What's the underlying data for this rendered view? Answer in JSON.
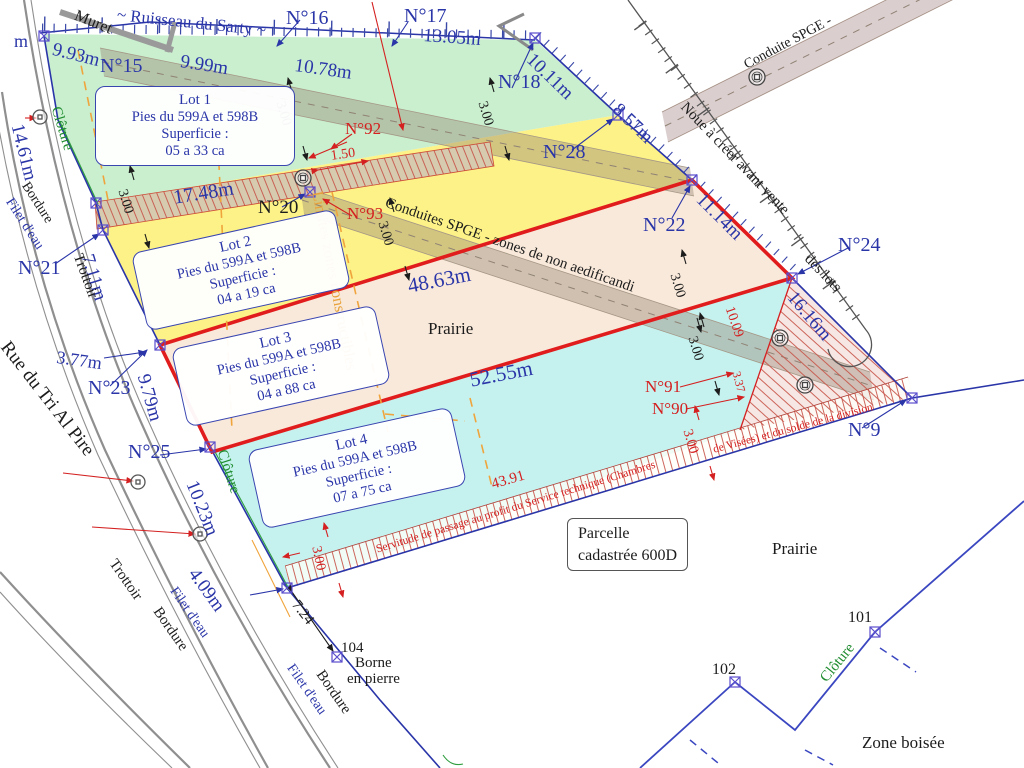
{
  "labels": {
    "ruisseau": "~ Ruisseau du Sarty ~",
    "muret": "Muret",
    "m_cut": "m",
    "n15": "N°15",
    "n16": "N°16",
    "n17": "N°17",
    "n18": "N°18",
    "n20": "N°20",
    "n21": "N°21",
    "n22": "N°22",
    "n23": "N°23",
    "n24": "N°24",
    "n25": "N°25",
    "n28": "N°28",
    "n9": "N°9",
    "n90": "N°90",
    "n91": "N°91",
    "n92": "N°92",
    "n93": "N°93",
    "d993": "9.93m",
    "d999": "9.99m",
    "d1078": "10.78m",
    "d1305": "13.05m",
    "d1011": "10.11m",
    "d857": "8.57m",
    "d1114": "11.14m",
    "d1616": "16.16m",
    "d1461": "14.61m",
    "d711": "7.11m",
    "d377": "3.77m",
    "d979": "9.79m",
    "d1023": "10.23m",
    "d409": "4.09m",
    "d1748": "17.48m",
    "d4863": "48.63m",
    "d5255": "52.55m",
    "d4391": "43.91",
    "d1009": "10.09",
    "d337": "3.37",
    "d150": "1.50",
    "d300": "3.00",
    "d724": "7.24",
    "noue1": "Noue à créer avant vente",
    "noue2": "des lots",
    "conduite_top": "Conduite SPGE -",
    "conduites_mid": "Conduites SPGE - zones de non aedificandi",
    "limites": "Limites zones constructibles",
    "servitude1": "Servitude de passage au profit du Service technique (Chambres",
    "servitude2": "de Visées) et du solde de la division",
    "rue": "Rue du Tri Al Pire",
    "trottoir": "Trottoir",
    "bordure": "Bordure",
    "filet": "Filet d'eau",
    "cloture": "Clôture",
    "prairie": "Prairie",
    "zone_boisee": "Zone boisée",
    "p101": "101",
    "p102": "102",
    "p104": "104",
    "borne1": "Borne",
    "borne2": "en pierre"
  },
  "lots": [
    {
      "title": "Lot 1",
      "owners": "Pies du 599A et 598B",
      "sup": "Superficie :",
      "area": "05 a 33 ca"
    },
    {
      "title": "Lot 2",
      "owners": "Pies du 599A et 598B",
      "sup": "Superficie :",
      "area": "04 a 19 ca"
    },
    {
      "title": "Lot 3",
      "owners": "Pies du 599A et 598B",
      "sup": "Superficie :",
      "area": "04 a 88 ca"
    },
    {
      "title": "Lot 4",
      "owners": "Pies du 599A et 598B",
      "sup": "Superficie :",
      "area": "07 a 75 ca"
    }
  ],
  "parcel_note": {
    "line1": "Parcelle",
    "line2": "cadastrée 600D"
  },
  "colors": {
    "boundary_blue": "#2a35a8",
    "red": "#d42020",
    "green": "#1f8c2f",
    "orange": "#e8a23c",
    "lot1_green": "#c9efce",
    "lot2_yellow": "#fcf287",
    "lot3_peach": "#f9e9da",
    "lot4_cyan": "#c5f2ef"
  }
}
